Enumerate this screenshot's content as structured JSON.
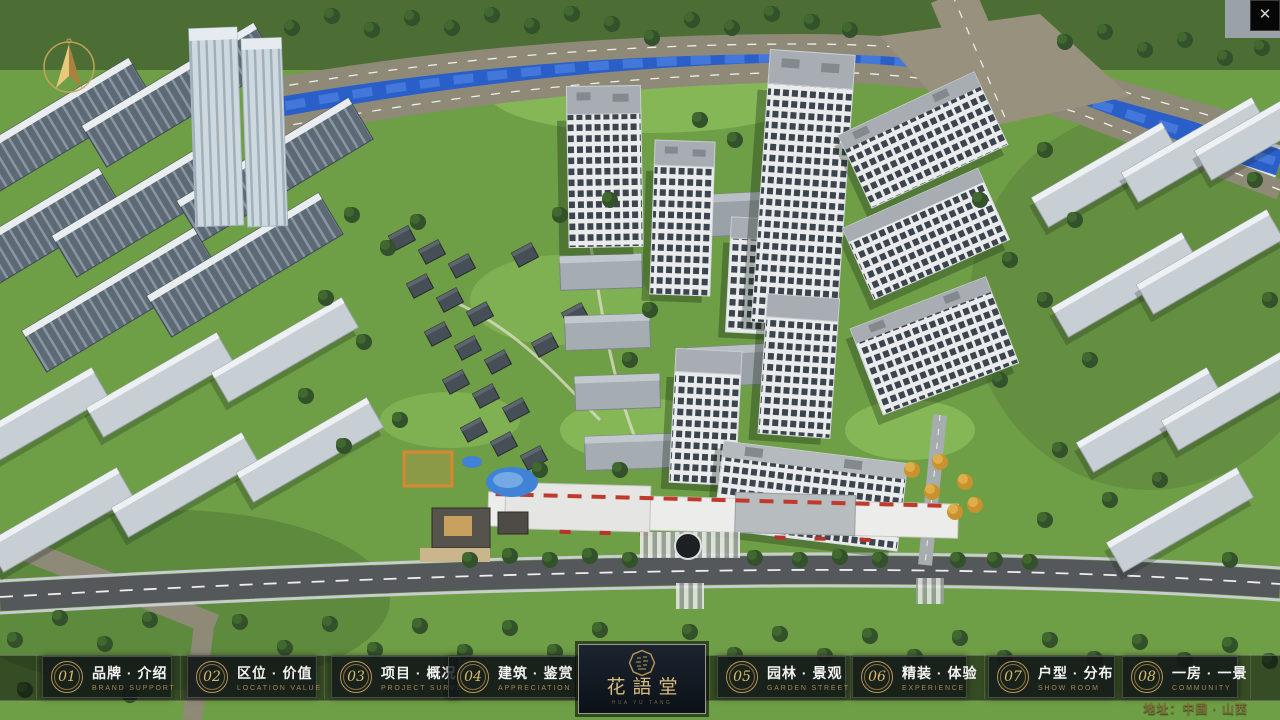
{
  "window": {
    "close_glyph": "✕"
  },
  "logo": {
    "title": "花語堂",
    "subtext": "HUA YU TANG"
  },
  "address": "地址：中国 · 山西",
  "colors": {
    "gold": "#c9a961",
    "gold_dim": "#9d8a52",
    "panel_bg": "#14181a",
    "band_bg": "rgba(8,10,10,0.55)",
    "river_blue": "#2a5ec8",
    "lawn_green": "#6e9e45"
  },
  "nav": {
    "items": [
      {
        "num": "01",
        "zh": "品牌 · 介绍",
        "en": "BRAND SUPPORT"
      },
      {
        "num": "02",
        "zh": "区位 · 价值",
        "en": "LOCATION VALUE"
      },
      {
        "num": "03",
        "zh": "项目 · 概况",
        "en": "PROJECT SURVEY"
      },
      {
        "num": "04",
        "zh": "建筑 · 鉴赏",
        "en": "APPRECIATION"
      },
      {
        "num": "05",
        "zh": "园林 · 景观",
        "en": "GARDEN STREET"
      },
      {
        "num": "06",
        "zh": "精装 · 体验",
        "en": "EXPERIENCE"
      },
      {
        "num": "07",
        "zh": "户型 · 分布",
        "en": "SHOW ROOM"
      },
      {
        "num": "08",
        "zh": "一房 · 一景",
        "en": "COMMUNITY"
      }
    ]
  }
}
